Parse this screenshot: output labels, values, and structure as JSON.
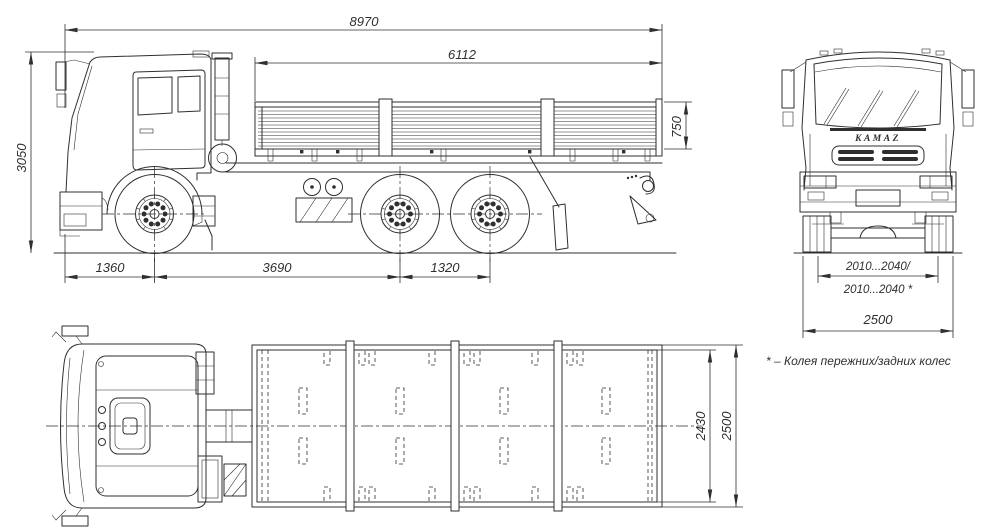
{
  "side_view": {
    "dims": {
      "overall_length": "8970",
      "platform_length": "6112",
      "overall_height": "3050",
      "board_height": "750",
      "front_overhang": "1360",
      "wheelbase": "3690",
      "bogie_spacing": "1320"
    }
  },
  "front_view": {
    "brand": "KAMAZ",
    "dims": {
      "track_top": "2010...2040/",
      "track_bottom": "2010...2040 *",
      "overall_width": "2500"
    }
  },
  "top_view": {
    "dims": {
      "platform_inner_width": "2430",
      "overall_width": "2500"
    }
  },
  "footnote": "* – Колея пережних/задних колес",
  "colors": {
    "line": "#2f2f2f",
    "background": "#ffffff"
  }
}
